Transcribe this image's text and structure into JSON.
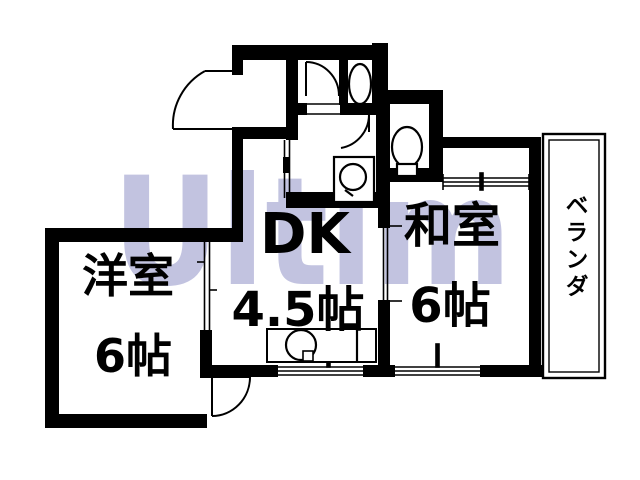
{
  "floorplan": {
    "watermark_text": "Ultim",
    "rooms": {
      "western": {
        "name": "洋室",
        "size": "6帖"
      },
      "dk": {
        "name": "DK",
        "size": "4.5帖"
      },
      "japanese": {
        "name": "和室",
        "size": "6帖"
      },
      "veranda": {
        "name": "ベランダ"
      }
    },
    "colors": {
      "line": "#000000",
      "background": "#ffffff",
      "watermark": "#c2c3e0"
    }
  }
}
